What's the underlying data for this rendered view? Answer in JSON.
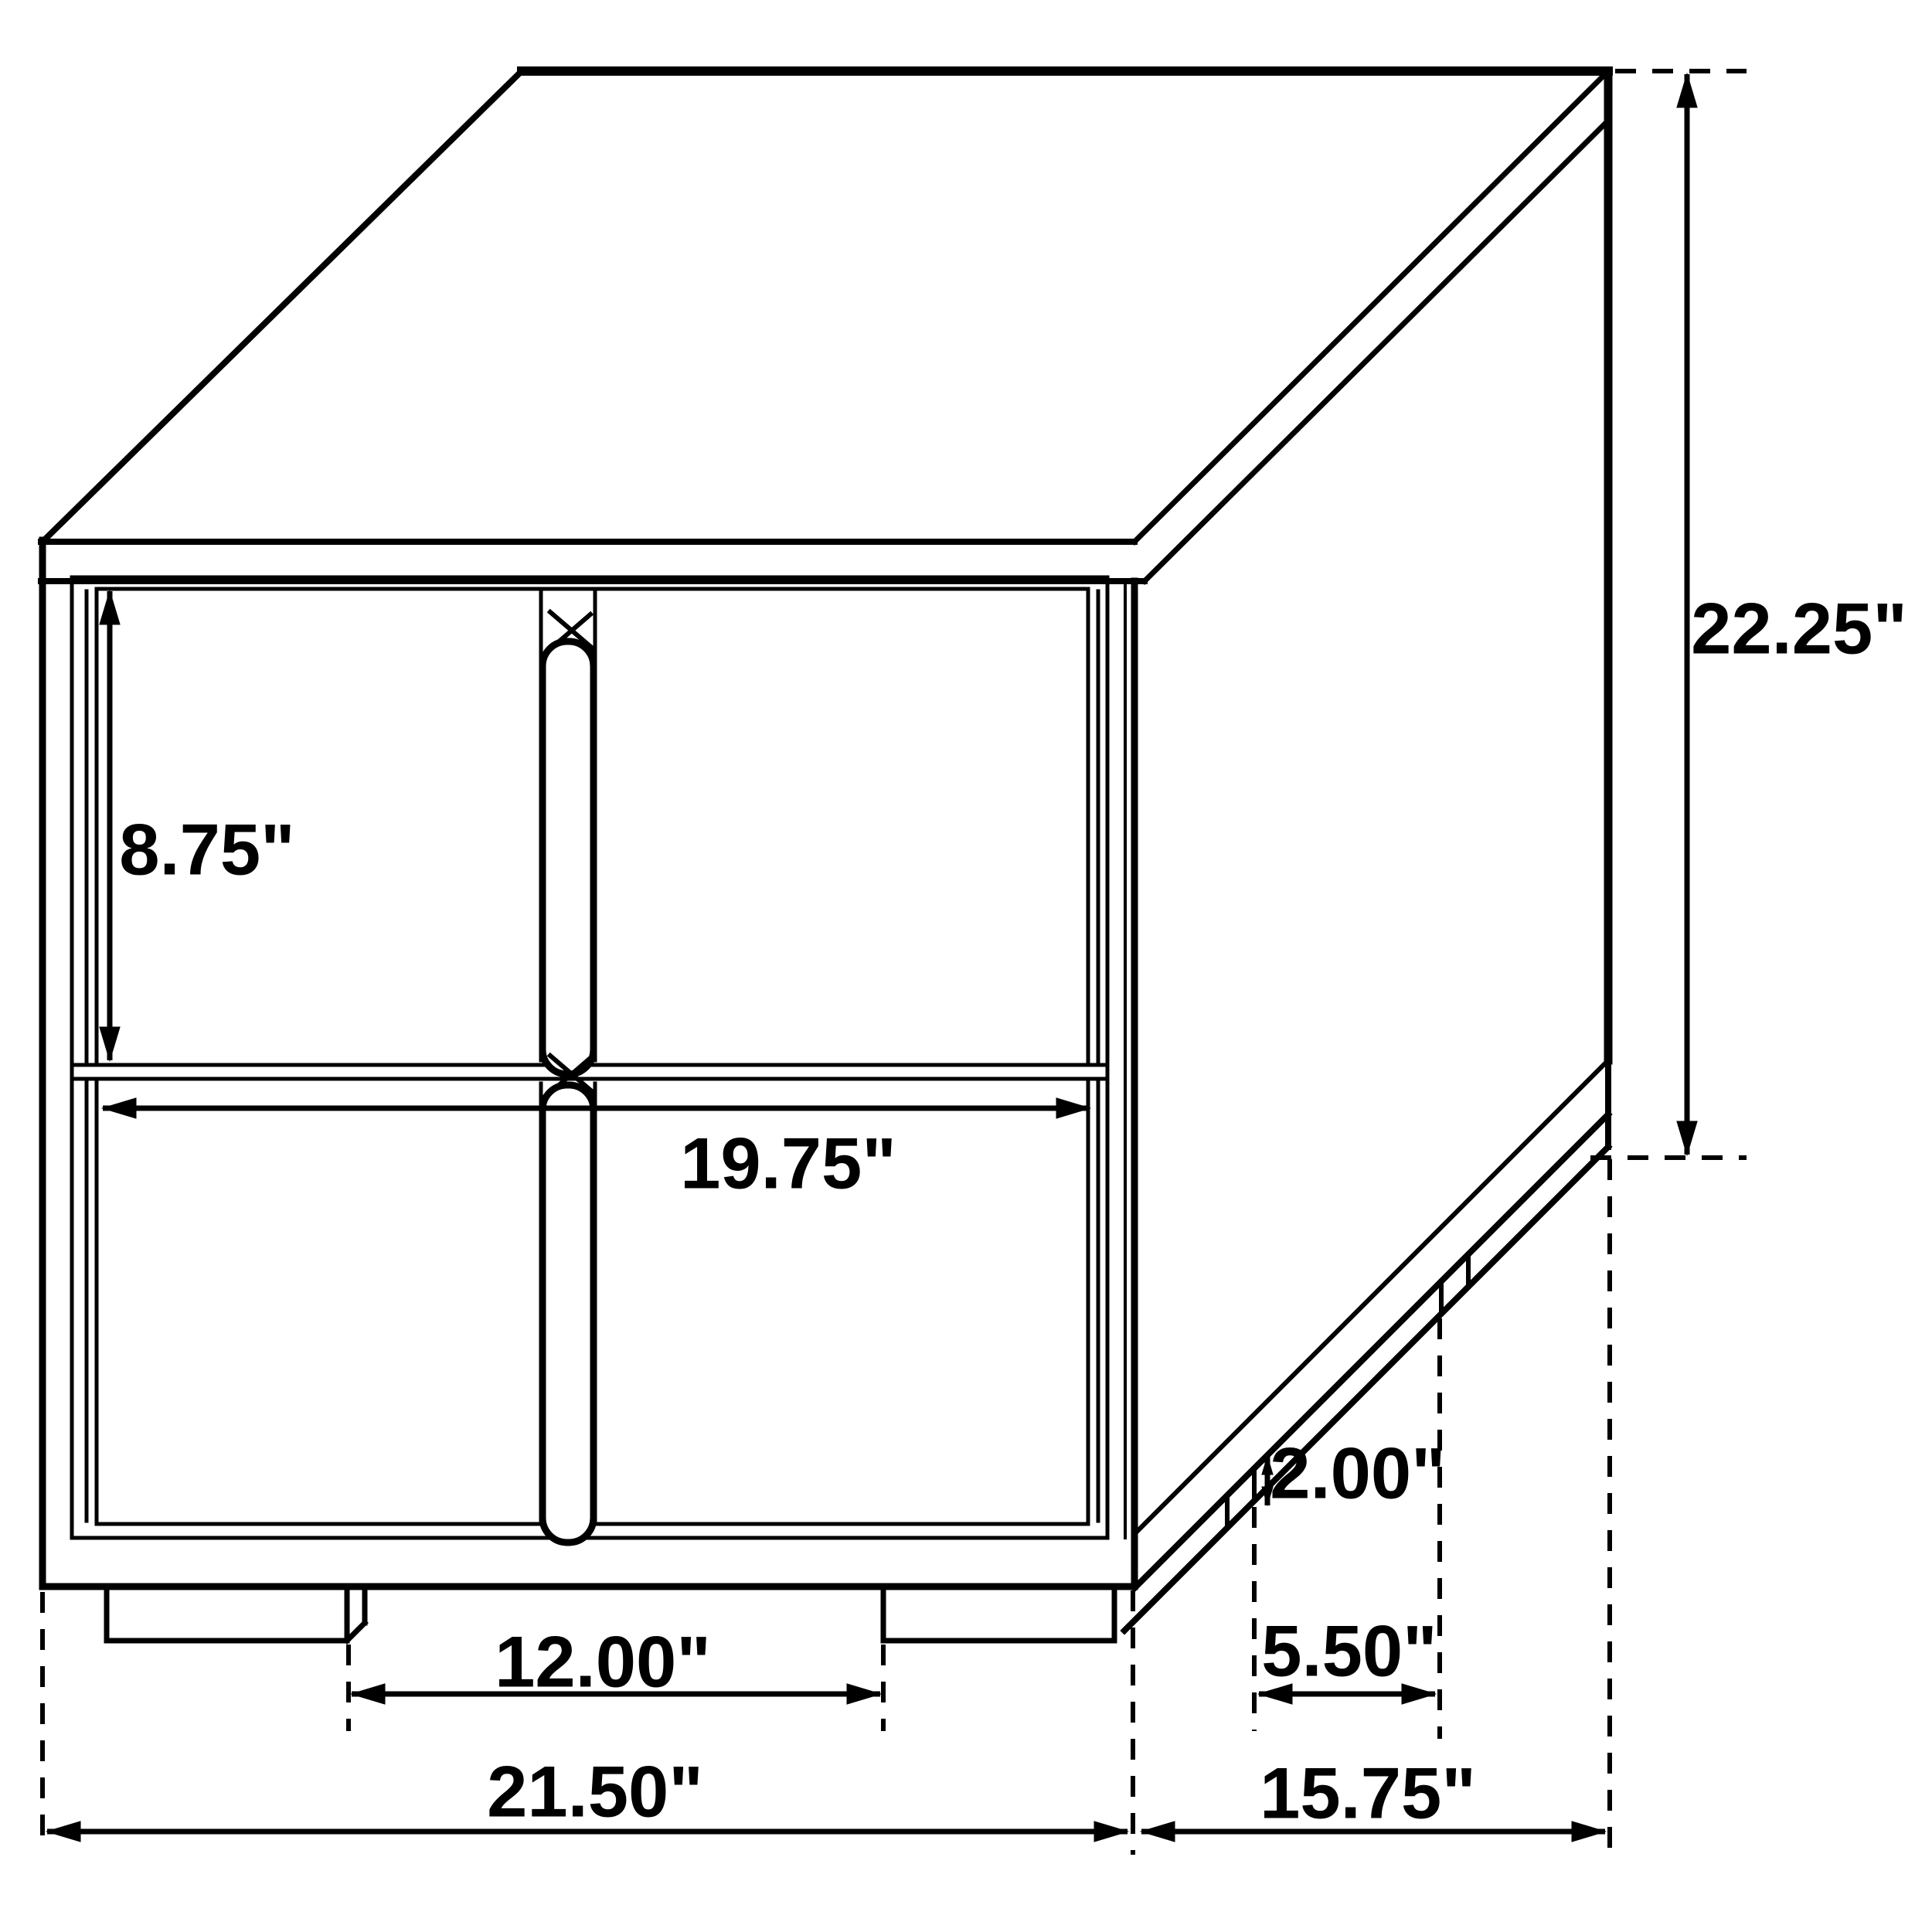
{
  "figure": {
    "title": "Nightstand dimension diagram",
    "type": "technical-line-drawing",
    "subject": "Two-drawer nightstand shown in three-quarter view with dimension callouts",
    "units": "inches",
    "background_color": "#ffffff",
    "line_color": "#000000"
  },
  "dimensions": {
    "drawer_height": {
      "label": "8.75\"",
      "value": 8.75,
      "unit": "in",
      "measures": "drawer front height"
    },
    "front_width": {
      "label": "19.75\"",
      "value": 19.75,
      "unit": "in",
      "measures": "drawer opening width"
    },
    "overall_height": {
      "label": "22.25\"",
      "value": 22.25,
      "unit": "in",
      "measures": "overall height"
    },
    "base_height": {
      "label": "2.00\"",
      "value": 2.0,
      "unit": "in",
      "measures": "base rail height"
    },
    "side_foot_gap": {
      "label": "5.50\"",
      "value": 5.5,
      "unit": "in",
      "measures": "spacing between side feet"
    },
    "front_foot_gap": {
      "label": "12.00\"",
      "value": 12.0,
      "unit": "in",
      "measures": "spacing between front feet"
    },
    "overall_width": {
      "label": "21.50\"",
      "value": 21.5,
      "unit": "in",
      "measures": "overall width"
    },
    "overall_depth": {
      "label": "15.75\"",
      "value": 15.75,
      "unit": "in",
      "measures": "overall depth"
    }
  }
}
